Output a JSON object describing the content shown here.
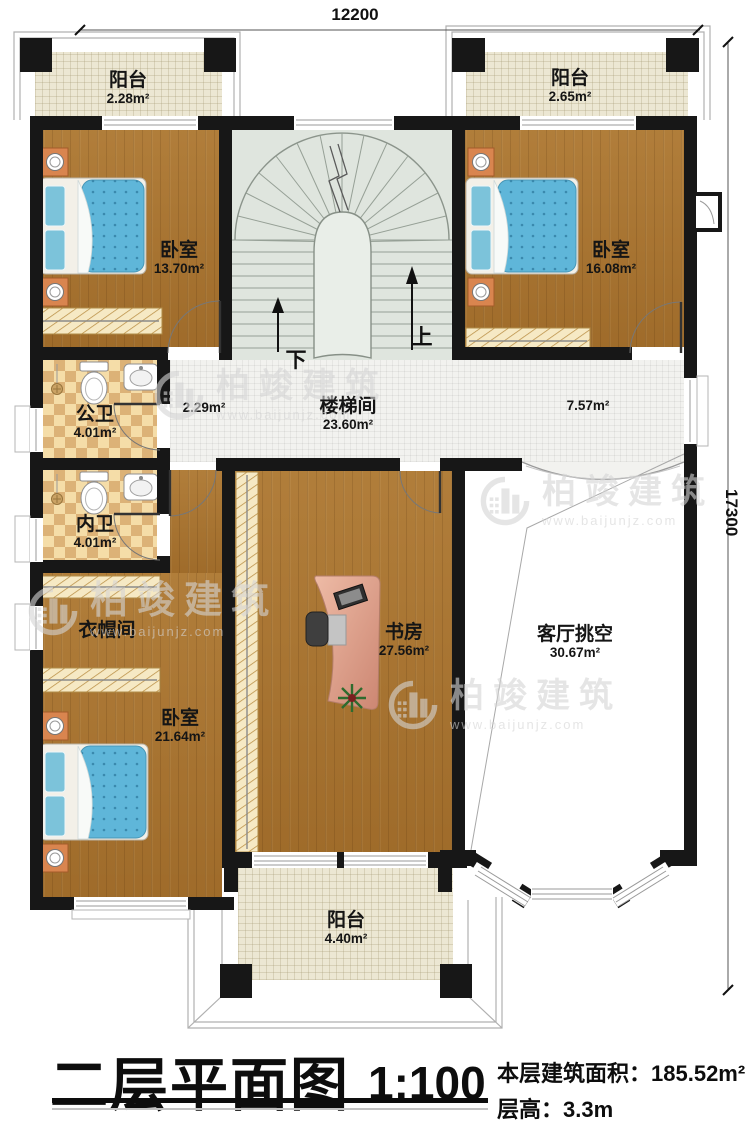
{
  "title": {
    "name": "二层平面图",
    "scale": "1:100",
    "area_label": "本层建筑面积：",
    "area_value": "185.52m²",
    "floor_height_label": "层高：",
    "floor_height_value": "3.3m"
  },
  "dims": {
    "width_mm": "12200",
    "height_mm": "17300"
  },
  "stairs": {
    "up_label": "上",
    "down_label": "下"
  },
  "watermark": {
    "brand": "柏竣建筑",
    "url": "www.baijunjz.com"
  },
  "rooms": [
    {
      "id": "balcony-tl",
      "name": "阳台",
      "area": "2.28m²"
    },
    {
      "id": "balcony-tr",
      "name": "阳台",
      "area": "2.65m²"
    },
    {
      "id": "bedroom-tl",
      "name": "卧室",
      "area": "13.70m²"
    },
    {
      "id": "bedroom-tr",
      "name": "卧室",
      "area": "16.08m²"
    },
    {
      "id": "stairwell",
      "name": "楼梯间",
      "area": "23.60m²"
    },
    {
      "id": "hall-west",
      "name": "",
      "area": "2.29m²"
    },
    {
      "id": "hall-east",
      "name": "",
      "area": "7.57m²"
    },
    {
      "id": "bath-public",
      "name": "公卫",
      "area": "4.01m²"
    },
    {
      "id": "bath-private",
      "name": "内卫",
      "area": "4.01m²"
    },
    {
      "id": "cloakroom",
      "name": "衣帽间",
      "area": ""
    },
    {
      "id": "bedroom-bl",
      "name": "卧室",
      "area": "21.64m²"
    },
    {
      "id": "study",
      "name": "书房",
      "area": "27.56m²"
    },
    {
      "id": "living-void",
      "name": "客厅挑空",
      "area": "30.67m²"
    },
    {
      "id": "balcony-bottom",
      "name": "阳台",
      "area": "4.40m²"
    }
  ],
  "colors": {
    "wall": "#171717",
    "wood_floor": "#a8732f",
    "balcony_floor": "#ece7d3",
    "corridor_floor": "#f2f2ef",
    "stair_floor": "#dfe5de",
    "bath_tile_light": "#f5dda8",
    "bath_tile_dark": "#dcb277",
    "mattress_blue": "#5fb6d9",
    "nightstand_orange": "#d9854f",
    "desk_salmon": "#dda08c"
  }
}
